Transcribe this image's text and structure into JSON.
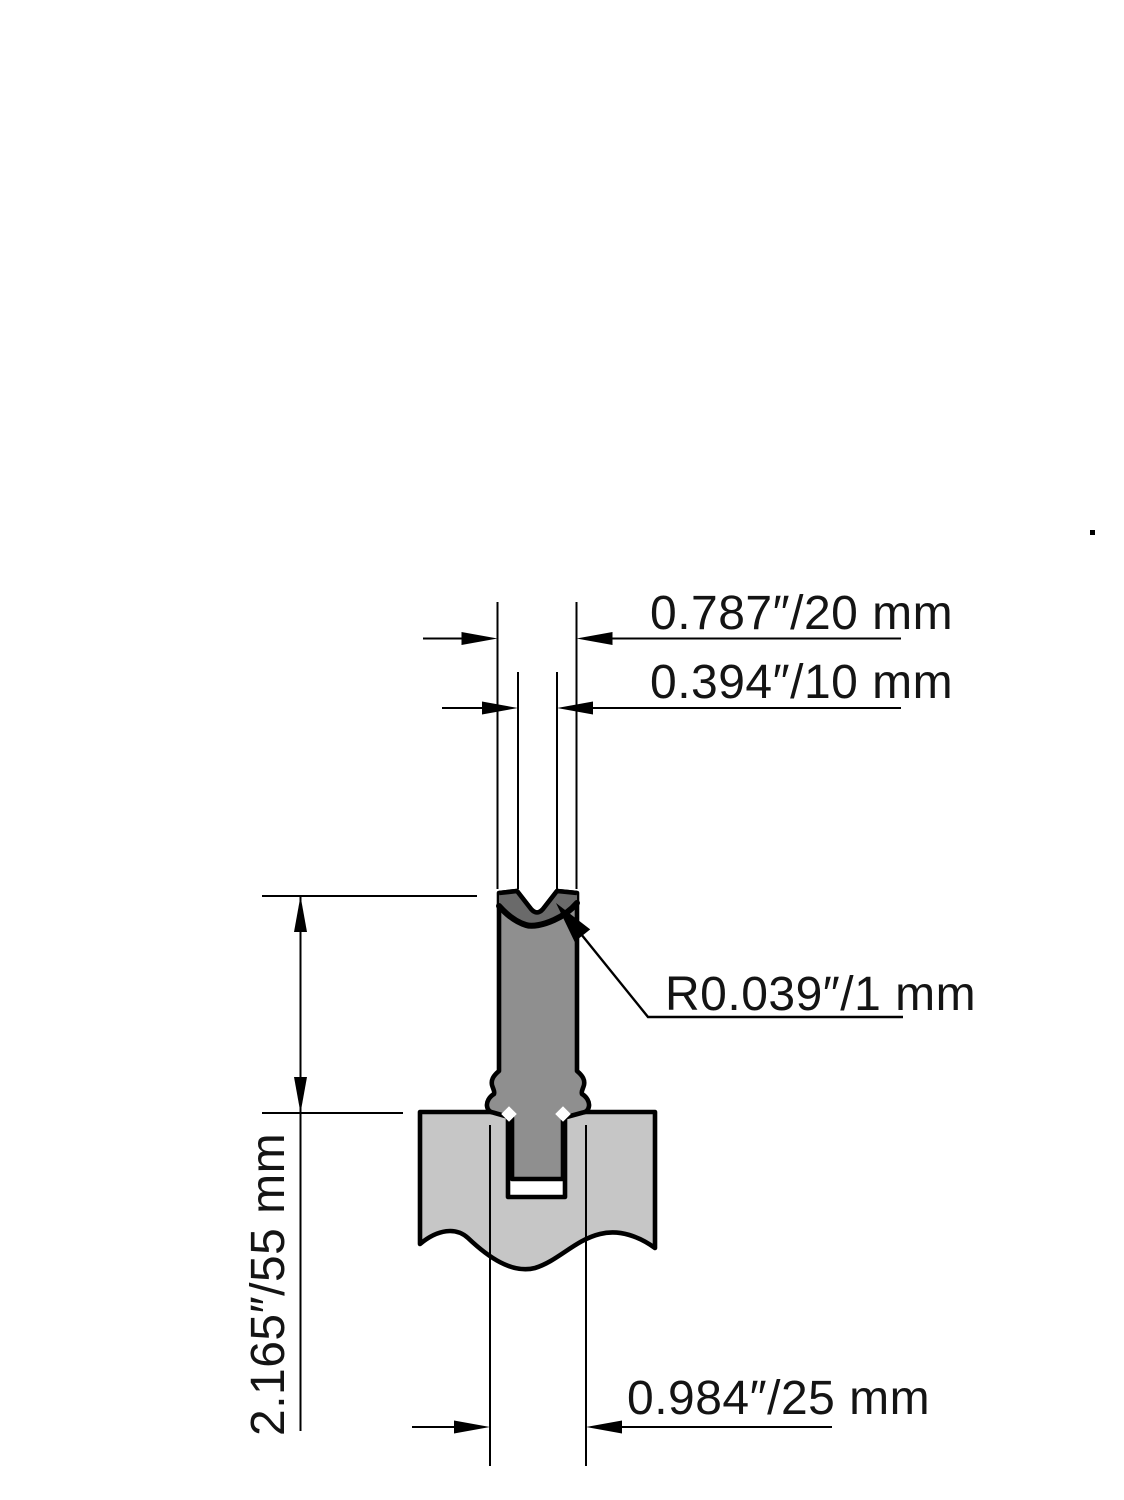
{
  "drawing": {
    "type": "technical-drawing",
    "subject": "Press brake lower die with V-groove seated in die holder, cross-section view",
    "units": "inches / millimeters"
  },
  "colors": {
    "die_body": "#8f8f8f",
    "hardened_zone": "#6a6a6a",
    "holder_body": "#c6c6c6",
    "line": "#000000",
    "background": "#ffffff"
  },
  "dimensions": {
    "body_width": {
      "label": "0.787″/20 mm",
      "inches": 0.787,
      "mm": 20
    },
    "v_opening": {
      "label": "0.394″/10 mm",
      "inches": 0.394,
      "mm": 10
    },
    "edge_radius": {
      "label": "R0.039″/1 mm",
      "inches": 0.039,
      "mm": 1
    },
    "body_height": {
      "label": "2.165″/55 mm",
      "inches": 2.165,
      "mm": 55
    },
    "tang_width": {
      "label": "0.984″/25 mm",
      "inches": 0.984,
      "mm": 25
    }
  }
}
